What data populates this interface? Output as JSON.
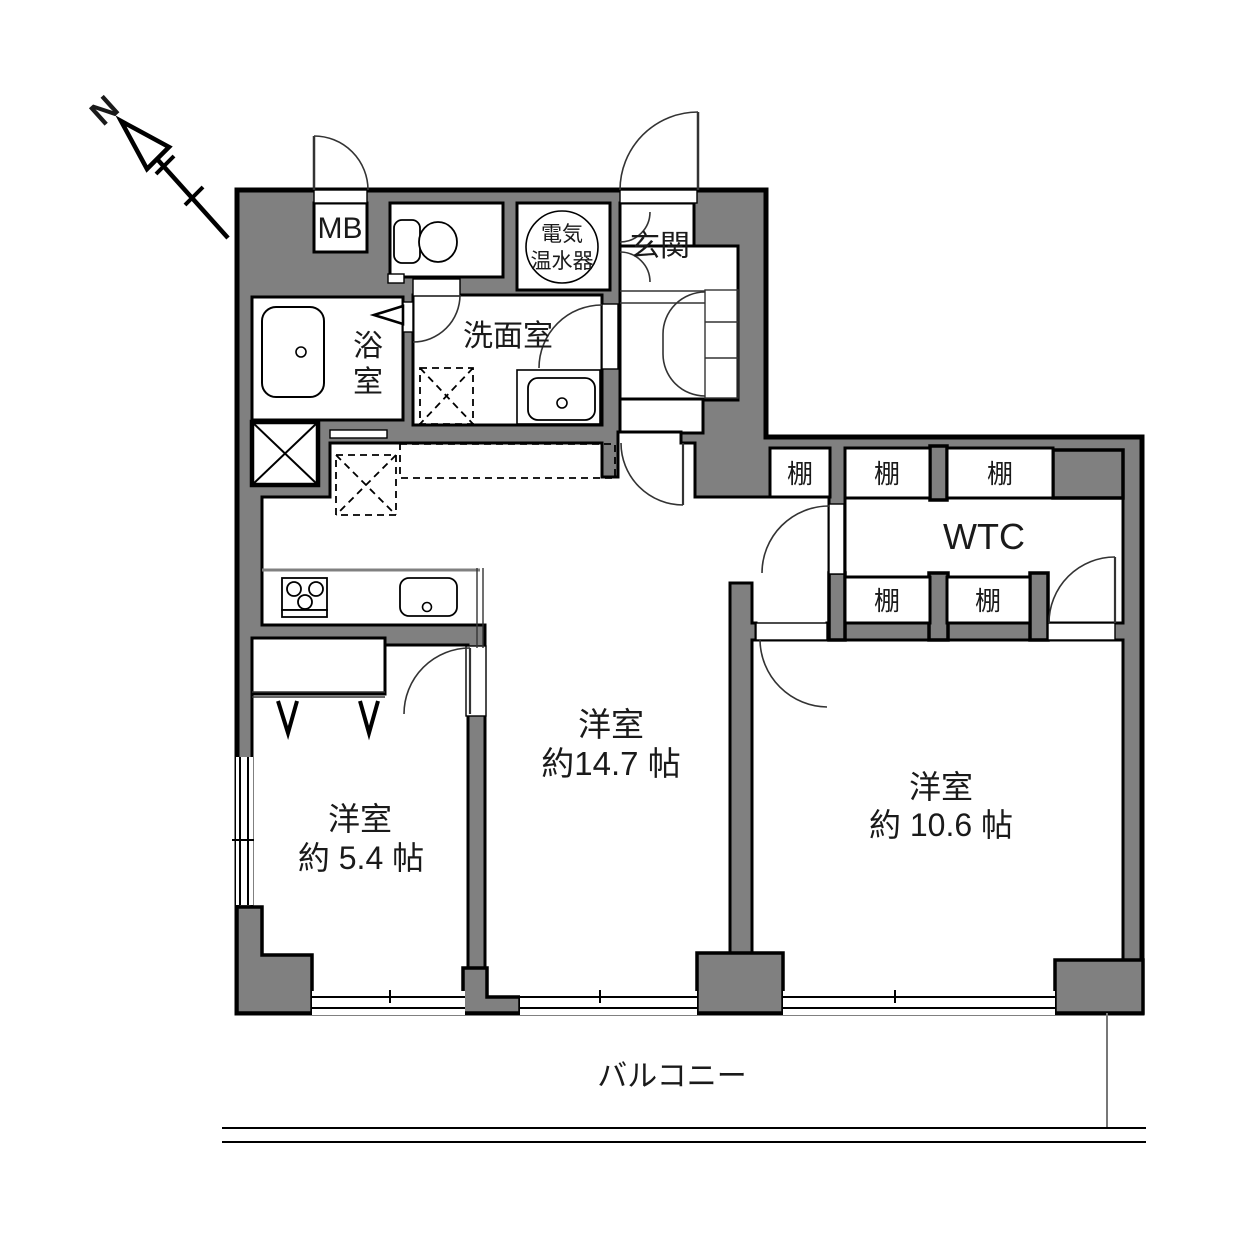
{
  "compass": {
    "label": "N"
  },
  "rooms": {
    "entrance": {
      "label": "玄関"
    },
    "mb": {
      "label": "MB"
    },
    "water_heater": {
      "l1": "電気",
      "l2": "温水器"
    },
    "washroom": {
      "label": "洗面室"
    },
    "bathroom": {
      "l1": "浴",
      "l2": "室"
    },
    "wtc": {
      "label": "WTC"
    },
    "shelf": {
      "label": "棚"
    },
    "living": {
      "name": "洋室",
      "size": "約14.7 帖"
    },
    "bedroom_small": {
      "name": "洋室",
      "size": "約 5.4 帖"
    },
    "bedroom_large": {
      "name": "洋室",
      "size": "約 10.6 帖"
    },
    "balcony": {
      "label": "バルコニー"
    }
  },
  "colors": {
    "wall": "#808080",
    "line": "#000000",
    "bg": "#ffffff"
  }
}
